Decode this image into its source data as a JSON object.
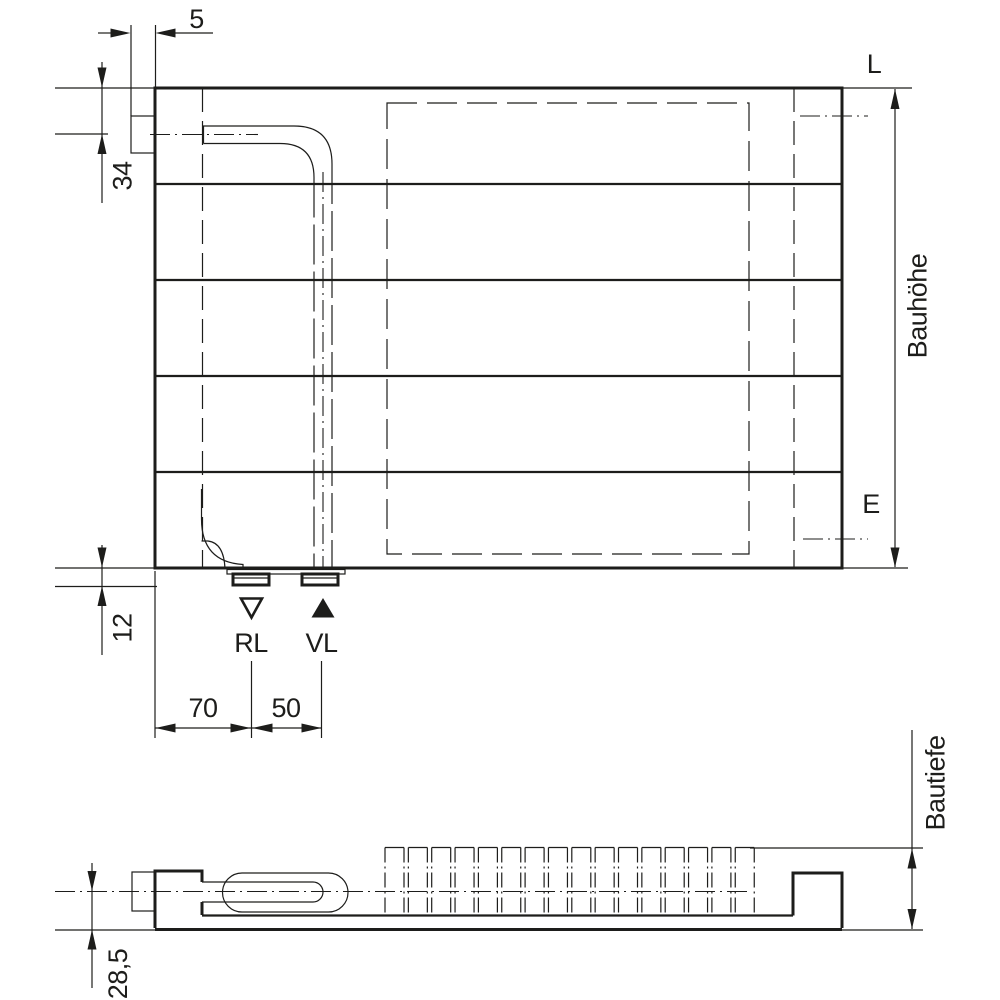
{
  "colors": {
    "line": "#1d1d1b",
    "background": "#ffffff"
  },
  "front_view": {
    "dims": {
      "tab_width": "5",
      "top_to_pipe_axis": "34",
      "connector_drop": "12",
      "edge_to_rl": "70",
      "rl_to_vl": "50"
    },
    "labels": {
      "top_level": "L",
      "drain_level": "E",
      "height": "Bauhöhe",
      "return": "RL",
      "supply": "VL"
    }
  },
  "section_view": {
    "dims": {
      "axis_to_back": "28,5"
    },
    "labels": {
      "depth": "Bautiefe"
    }
  }
}
